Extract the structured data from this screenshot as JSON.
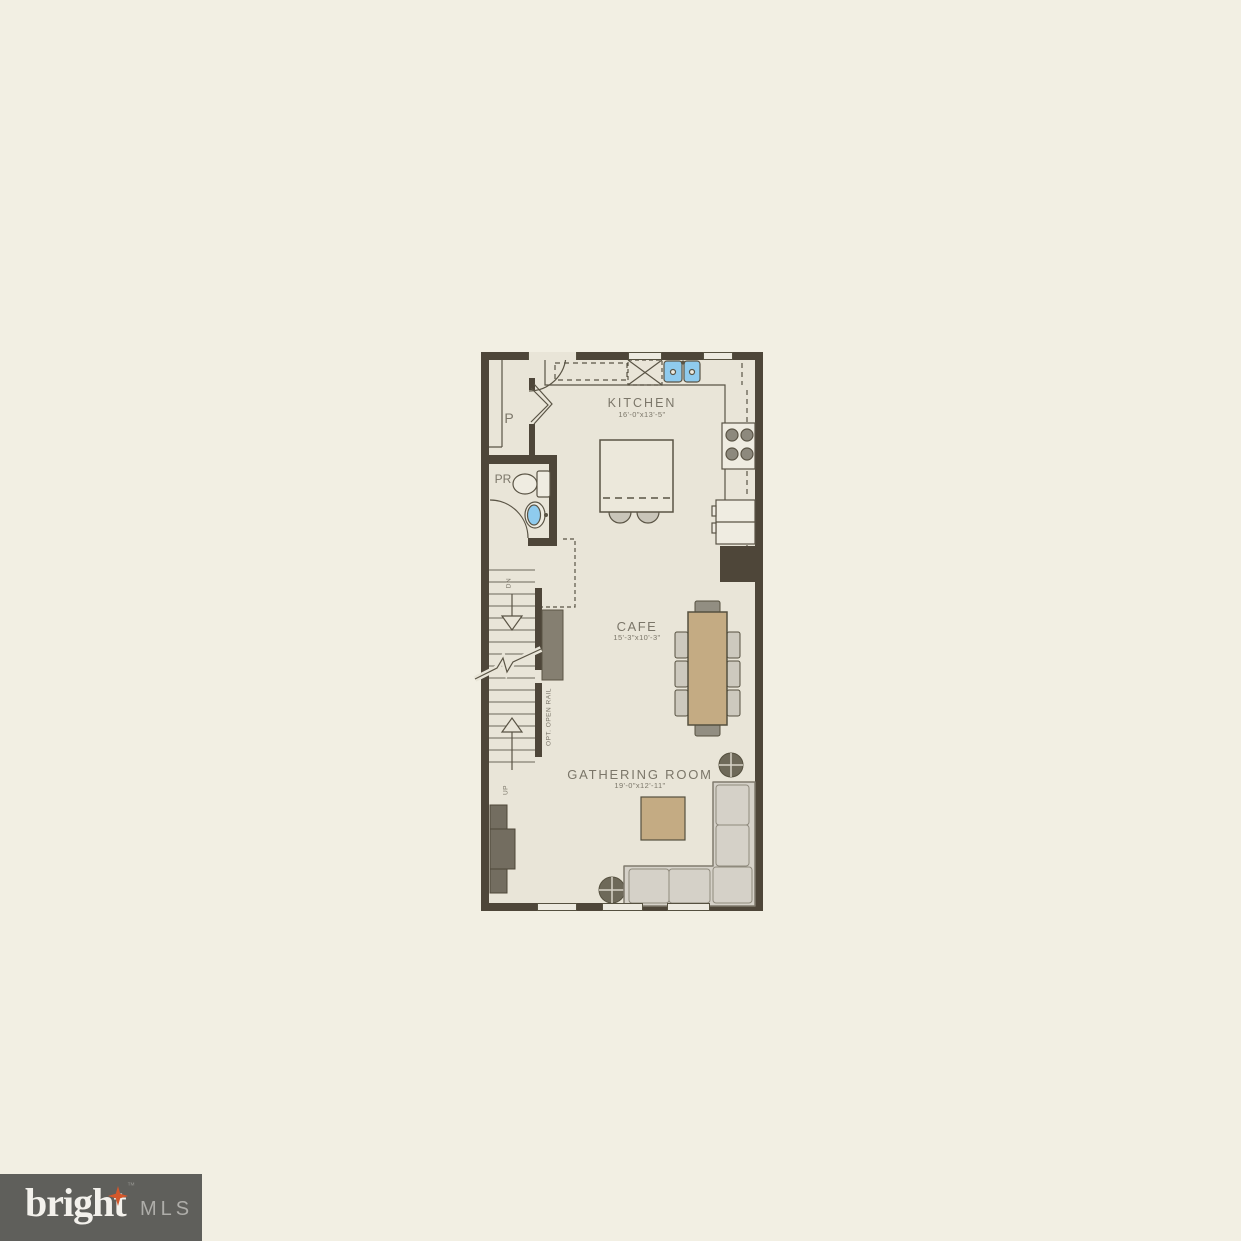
{
  "plan": {
    "rooms": {
      "kitchen": {
        "name": "KITCHEN",
        "dims": "16'-0\"x13'-5\""
      },
      "cafe": {
        "name": "CAFE",
        "dims": "15'-3\"x10'-3\""
      },
      "gathering_room": {
        "name": "GATHERING ROOM",
        "dims": "19'-0\"x12'-11\""
      },
      "pantry": {
        "name": "P"
      },
      "powder_room": {
        "name": "PR"
      }
    },
    "stairs": {
      "down": "DN",
      "up": "UP",
      "rail_note": "OPT. OPEN RAIL"
    },
    "colors": {
      "wall": "#4E4639",
      "floor": "#E9E5D8",
      "background": "#F2EFE3",
      "table_tan": "#C4AB83",
      "sink_blue": "#8FCBEE",
      "furniture_gray": "#D5D1C8"
    }
  },
  "logo": {
    "brand": "bright",
    "trademark": "™",
    "suffix": "MLS",
    "accent_color": "#D4572A",
    "box_color": "#5F5F5B"
  }
}
